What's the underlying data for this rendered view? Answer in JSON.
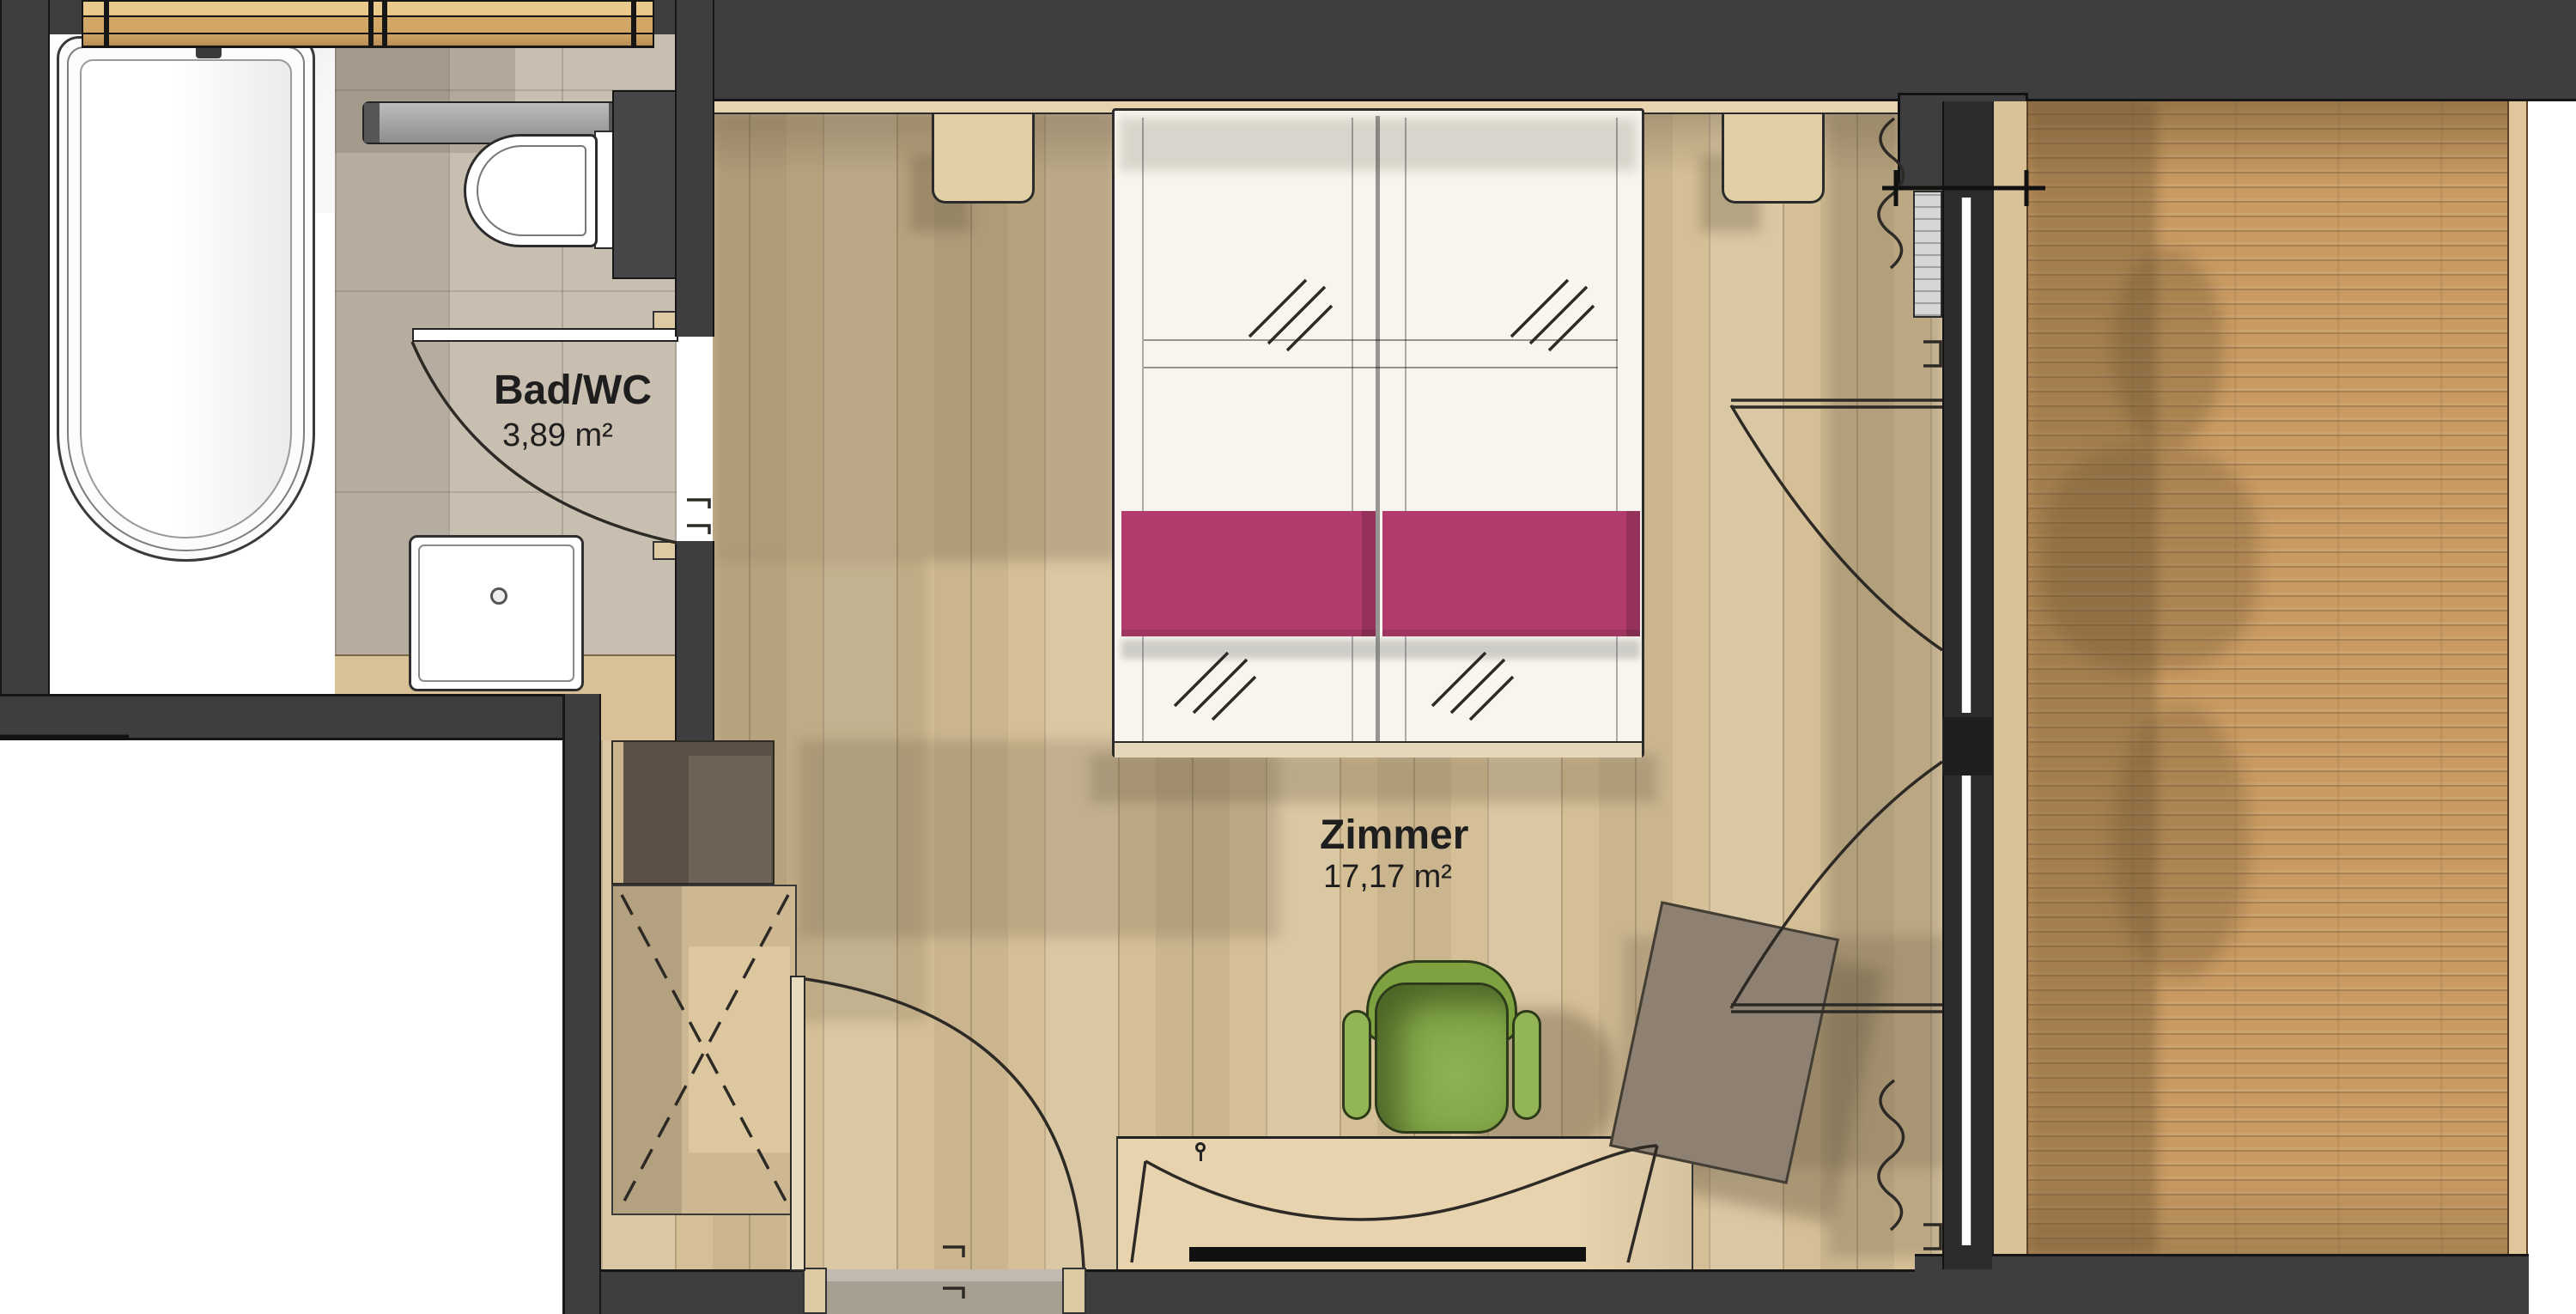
{
  "labels": {
    "bathroom": {
      "name": "Bad/WC",
      "area": "3,89 m²"
    },
    "bedroom": {
      "name": "Zimmer",
      "area": "17,17 m²"
    }
  },
  "palette": {
    "wall": "#3e3e40",
    "outline": "#1f1d1a",
    "floor": "#d5bf96",
    "tile": "#c8bfb1",
    "deck": "#c99b62",
    "bed_white": "#f8f5ee",
    "runner_pink": "#b23b6d",
    "chair_green": "#7fa344",
    "ottoman_taupe": "#8e8171",
    "wood_light": "#e7d3ad",
    "window_wood": "#d2a766",
    "threshold_gray": "#a89f93",
    "glass": "#fdfdfd",
    "white": "#ffffff"
  }
}
